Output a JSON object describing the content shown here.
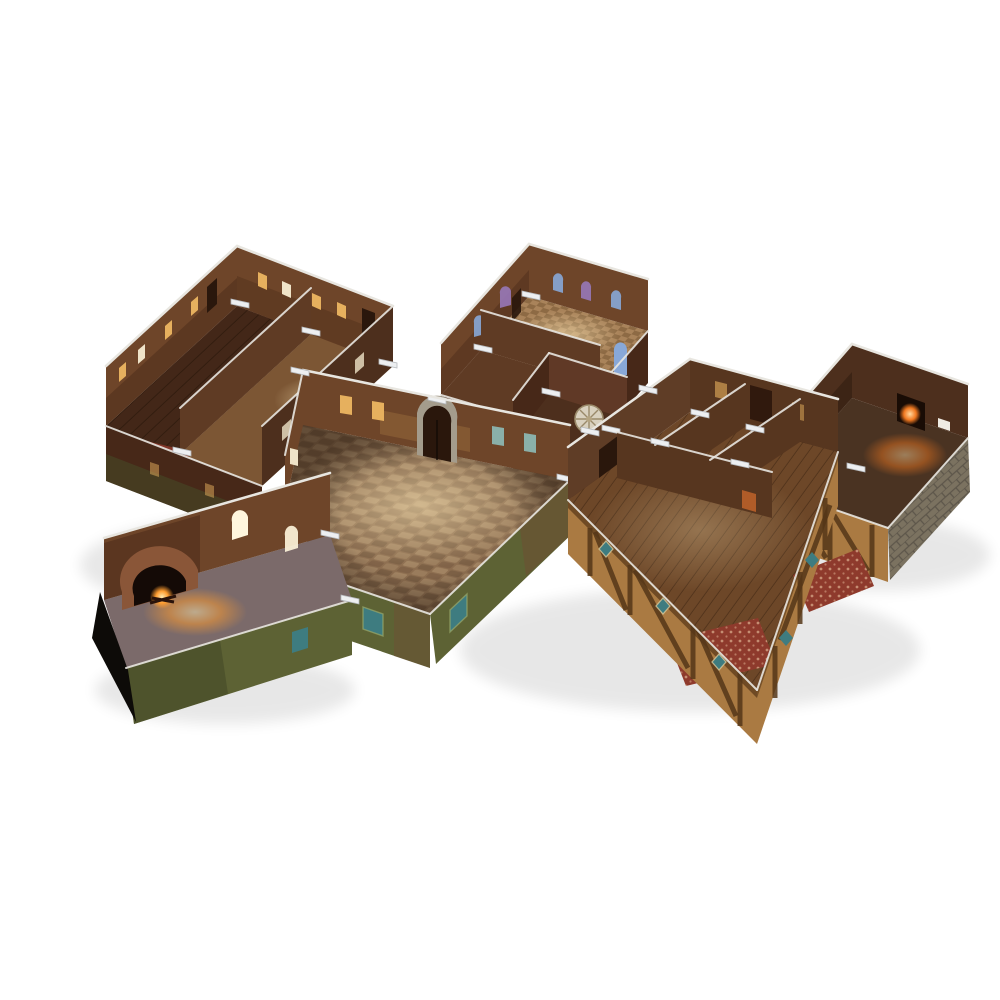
{
  "scene": {
    "type": "product-photo",
    "background": "#ffffff",
    "description": "Isometric render of a modular cardboard fantasy tavern terrain set: connected fold-out rooms with printed floors and walls, white plastic wall clips, on a plain white background",
    "modules": [
      {
        "id": "tavern-back-rooms",
        "label": "Two-room tavern block with dark plank floors, red rug and lit brick walls"
      },
      {
        "id": "chapel",
        "label": "Chapel room with arched stained glass windows and bedroom annex with striped bed"
      },
      {
        "id": "connector-room",
        "label": "Small connector room with pale round wheel leaning on wall"
      },
      {
        "id": "forge-room",
        "label": "Dark workshop room with glowing furnace and grey stone outer wall"
      },
      {
        "id": "main-hall",
        "label": "Large hall with cobblestone floor, stone arched doorway and mossy outer walls"
      },
      {
        "id": "inn-bedrooms",
        "label": "Inn block with partitioned bedrooms, wooden plank floors, red rugs and timber-framed outer walls"
      },
      {
        "id": "kitchen",
        "label": "Kitchen annex with arched fireplace, glowing fire and black cardboard end panel"
      }
    ]
  },
  "palette": {
    "bg": "#ffffff",
    "edge": "#e8e6e0",
    "clip": "#edeff1",
    "clipEdge": "#b6babe",
    "brickMid": "#6e4529",
    "brickShadow": "#472818",
    "woodWallDark": "#4d2f1d",
    "woodWallMid": "#5f3b24",
    "plankDark": "#432718",
    "plankLine": "#2e1a0d",
    "floorBrown": "#7c5634",
    "rugRed": "#8e3a2c",
    "rugDot": "#d3a183",
    "cobbleBase": "#8d6e50",
    "cobbleLight": "#bb9d77",
    "cobbleDark": "#5c4430",
    "moss": "#5d6234",
    "mossDark": "#454a28",
    "mossLight": "#767c45",
    "mossBrown": "#6d5034",
    "timberTan": "#aa7a42",
    "timberBeam": "#553618",
    "tealWin": "#3e7c80",
    "tealWinLight": "#8fc3c0",
    "glowWarm": "#e6b05e",
    "glowWhite": "#efe3c8",
    "glowCore": "#fff6dd",
    "stainPurple": "#9878b8",
    "stainTeal": "#5fb0ac",
    "stainBlue": "#88a8d8",
    "stainPink": "#c9a3cb",
    "stoneArch": "#a49c8c",
    "doorDark": "#2a170c",
    "chapelFloor": "#a9835a",
    "chapelFloorDark": "#8d6a44",
    "bedWhite": "#eae6e2",
    "bedStripe": "#96689a",
    "connectorWall": "#603926",
    "wheelPale": "#d9d1bf",
    "forgeGlow": "#f07820",
    "forgeCore": "#ffd9a0",
    "fireOrange": "#ff9d30",
    "fireCore": "#ffeab0",
    "kitchenFloor": "#7b6a6a",
    "innFloor": "#6d4728",
    "innWall": "#57361f",
    "stoneGray": "#7b7260",
    "stoneGrayDark": "#5d564a",
    "black": "#0d0b08",
    "shadow": "#000000"
  }
}
